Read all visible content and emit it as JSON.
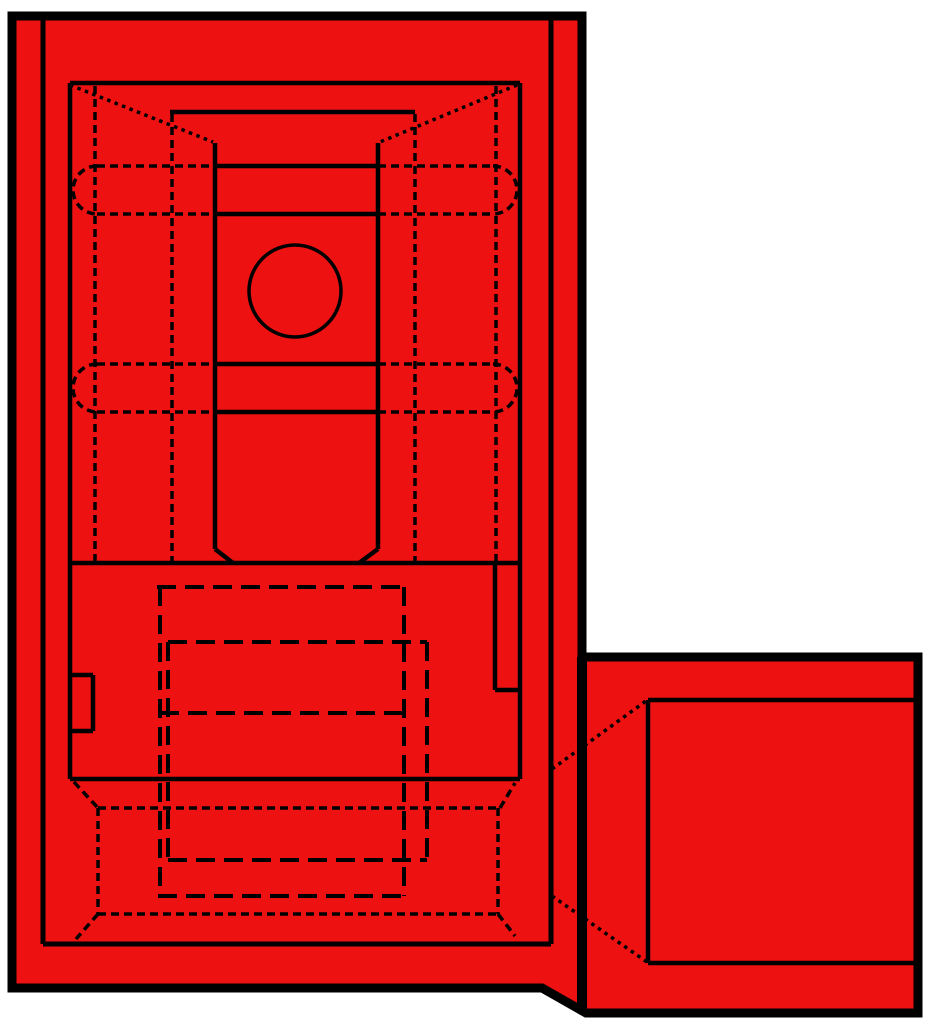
{
  "drawing": {
    "description": "Technical hidden-line drawing of a red fully-insulated flag-type quick-disconnect terminal, top view with wire barrel extension at lower right",
    "canvas": {
      "width": 936,
      "height": 1024
    },
    "colors": {
      "background": "#ffffff",
      "body_fill": "#ee1111",
      "line": "#000000"
    },
    "silhouette": {
      "path": "M 12 16 L 582 16 L 582 657 L 918 657 L 918 1013 L 586 1013 L 542 988 L 12 988 Z",
      "border_width": 9
    },
    "circle": {
      "cx": 295,
      "cy": 291,
      "r": 46,
      "width": 3.5
    },
    "line_groups": [
      {
        "name": "body-extension-divider",
        "width": 10,
        "dash": "",
        "segments": [
          [
            582,
            657,
            582,
            1008
          ]
        ],
        "paths": []
      },
      {
        "name": "insulation-inner-outline",
        "width": 5,
        "dash": "",
        "segments": [
          [
            43,
            18,
            43,
            944
          ],
          [
            43,
            944,
            551,
            944
          ],
          [
            551,
            18,
            551,
            944
          ]
        ],
        "paths": []
      },
      {
        "name": "visible-edges",
        "width": 4.5,
        "dash": "",
        "segments": [
          [
            70,
            83,
            70,
            779
          ],
          [
            70,
            83,
            520,
            83
          ],
          [
            520,
            83,
            520,
            779
          ],
          [
            170,
            112,
            415,
            112
          ],
          [
            215,
            143,
            215,
            549
          ],
          [
            378,
            143,
            378,
            549
          ],
          [
            215,
            549,
            233,
            563
          ],
          [
            378,
            549,
            359,
            563
          ],
          [
            70,
            563,
            520,
            563
          ],
          [
            215,
            166,
            378,
            166
          ],
          [
            215,
            214,
            378,
            214
          ],
          [
            215,
            364,
            378,
            364
          ],
          [
            215,
            412,
            378,
            412
          ],
          [
            70,
            779,
            520,
            779
          ],
          [
            70,
            675,
            93,
            675
          ],
          [
            93,
            675,
            93,
            731
          ],
          [
            93,
            731,
            70,
            731
          ],
          [
            495,
            563,
            495,
            690
          ],
          [
            495,
            690,
            520,
            690
          ],
          [
            648,
            700,
            914,
            700
          ],
          [
            648,
            700,
            648,
            963
          ],
          [
            648,
            963,
            914,
            963
          ]
        ],
        "paths": []
      },
      {
        "name": "hidden-edges",
        "width": 3.5,
        "dash": "8 5",
        "segments": [
          [
            95,
            86,
            95,
            561
          ],
          [
            172,
            114,
            172,
            561
          ],
          [
            415,
            114,
            415,
            561
          ],
          [
            496,
            86,
            496,
            561
          ],
          [
            97,
            166,
            215,
            166
          ],
          [
            378,
            166,
            493,
            166
          ],
          [
            97,
            214,
            215,
            214
          ],
          [
            378,
            214,
            493,
            214
          ],
          [
            97,
            364,
            215,
            364
          ],
          [
            378,
            364,
            493,
            364
          ],
          [
            97,
            412,
            215,
            412
          ],
          [
            378,
            412,
            493,
            412
          ],
          [
            98,
            808,
            500,
            808
          ],
          [
            98,
            914,
            498,
            914
          ],
          [
            98,
            808,
            98,
            914
          ],
          [
            498,
            808,
            498,
            914
          ],
          [
            74,
            782,
            98,
            808
          ],
          [
            500,
            808,
            515,
            783
          ],
          [
            98,
            914,
            76,
            939
          ],
          [
            498,
            914,
            515,
            936
          ]
        ],
        "paths": [
          "M 97 166 A 24 24 0 0 0 97 214",
          "M 493 166 A 24 24 0 0 1 493 214",
          "M 97 364 A 24 24 0 0 0 97 412",
          "M 493 364 A 24 24 0 0 1 493 412"
        ]
      },
      {
        "name": "wire-barrel-hidden-edges",
        "width": 4,
        "dash": "19 9",
        "segments": [
          [
            157,
            587,
            403,
            587
          ],
          [
            160,
            587,
            160,
            896
          ],
          [
            168,
            642,
            427,
            642
          ],
          [
            168,
            642,
            168,
            860
          ],
          [
            160,
            713,
            403,
            713
          ],
          [
            168,
            860,
            427,
            860
          ],
          [
            158,
            896,
            404,
            896
          ],
          [
            404,
            587,
            404,
            896
          ],
          [
            427,
            642,
            427,
            861
          ]
        ],
        "paths": []
      },
      {
        "name": "phantom-diagonals",
        "width": 3.5,
        "dash": "3.5 4.5",
        "segments": [
          [
            70,
            85,
            213,
            142
          ],
          [
            517,
            85,
            380,
            142
          ],
          [
            552,
            769,
            646,
            701
          ],
          [
            552,
            896,
            647,
            962
          ]
        ],
        "paths": []
      }
    ]
  }
}
